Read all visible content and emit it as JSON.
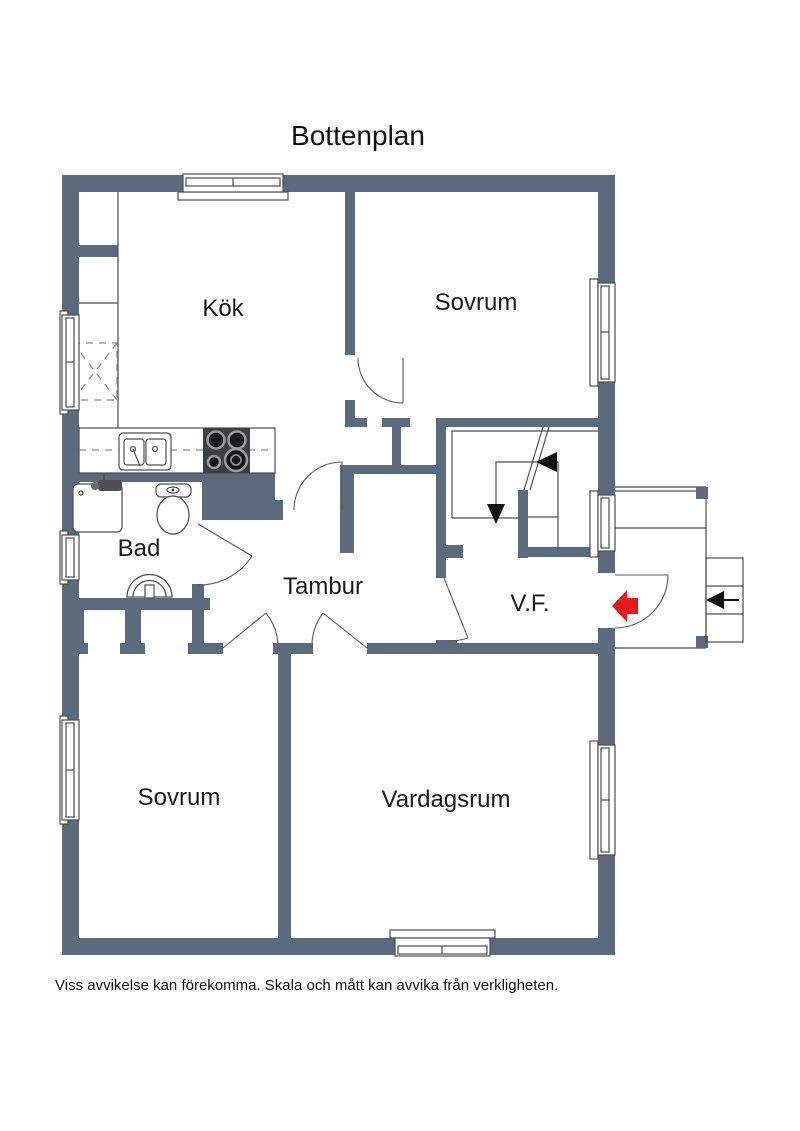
{
  "title": "Bottenplan",
  "floorplan": {
    "rooms": [
      {
        "label": "Kök"
      },
      {
        "label": "Sovrum"
      },
      {
        "label": "Bad"
      },
      {
        "label": "Tambur"
      },
      {
        "label": "V.F."
      },
      {
        "label": "Sovrum"
      },
      {
        "label": "Vardagsrum"
      }
    ],
    "colors": {
      "wall": "#5c6a7e",
      "entrance_arrow": "#e8191c",
      "line": "#4d4d4d"
    }
  },
  "disclaimer": "Viss avvikelse kan förekomma. Skala och mått kan avvika från verkligheten."
}
